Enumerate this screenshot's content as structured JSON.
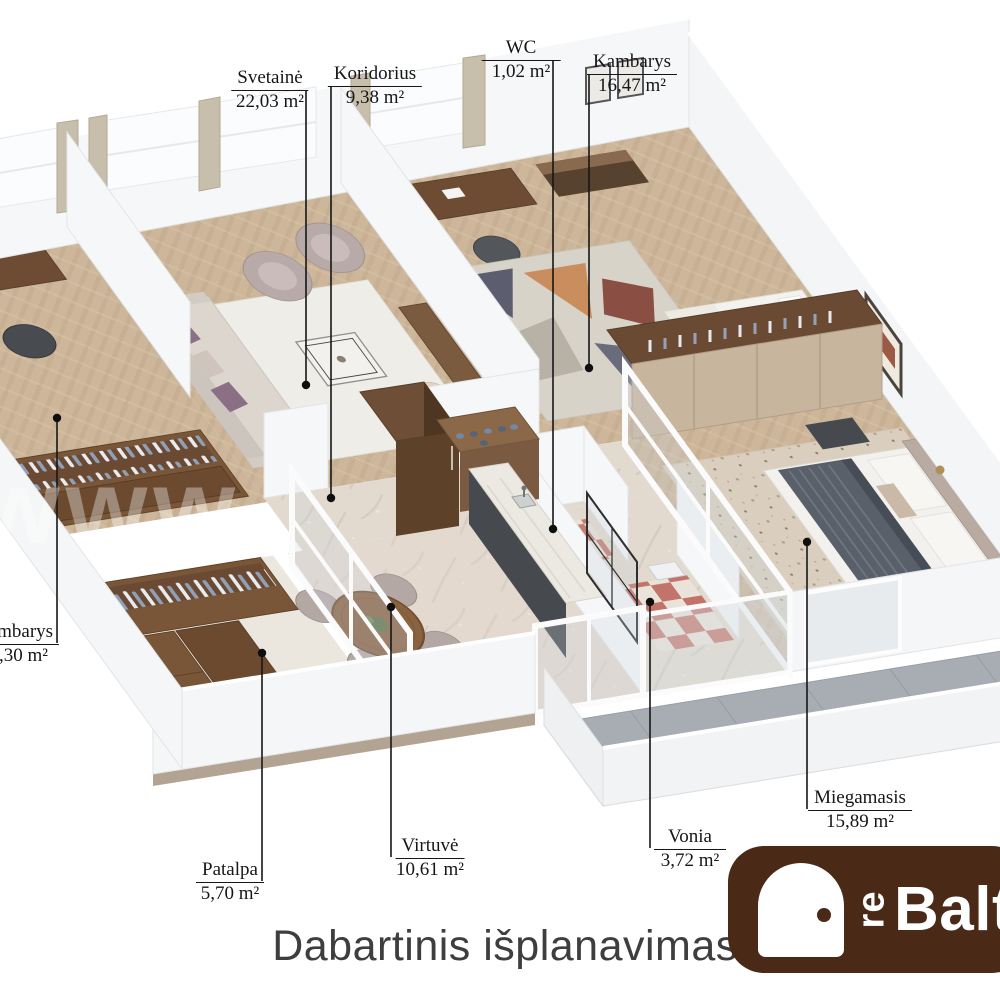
{
  "title": "Dabartinis išplanavimas",
  "watermark": "www",
  "logo": {
    "prefix": "re",
    "name": "Baltic",
    "icon": "door-icon",
    "background": "#4a2a17",
    "text_color": "#ffffff"
  },
  "rooms": [
    {
      "id": "svetaine",
      "name": "Svetainė",
      "area": "22,03 m²"
    },
    {
      "id": "koridorius",
      "name": "Koridorius",
      "area": "9,38 m²"
    },
    {
      "id": "wc",
      "name": "WC",
      "area": "1,02 m²"
    },
    {
      "id": "kambarys",
      "name": "Kambarys",
      "area": "16,47 m²"
    },
    {
      "id": "kambarys-left",
      "name": "Kambarys",
      "area": "15,30 m²"
    },
    {
      "id": "patalpa",
      "name": "Patalpa",
      "area": "5,70 m²"
    },
    {
      "id": "virtuve",
      "name": "Virtuvė",
      "area": "10,61 m²"
    },
    {
      "id": "vonia",
      "name": "Vonia",
      "area": "3,72 m²"
    },
    {
      "id": "miegamasis",
      "name": "Miegamasis",
      "area": "15,89 m²"
    }
  ],
  "colors": {
    "label_text": "#161616",
    "title_text": "#3e3e3e",
    "wall": "#f5f6f7",
    "floor_wood": "#cdb69a",
    "floor_marble": "#e2dacf",
    "cabinet_brown": "#7a5638",
    "balcony_gray": "#a7adb2",
    "leader_line": "#161616"
  }
}
